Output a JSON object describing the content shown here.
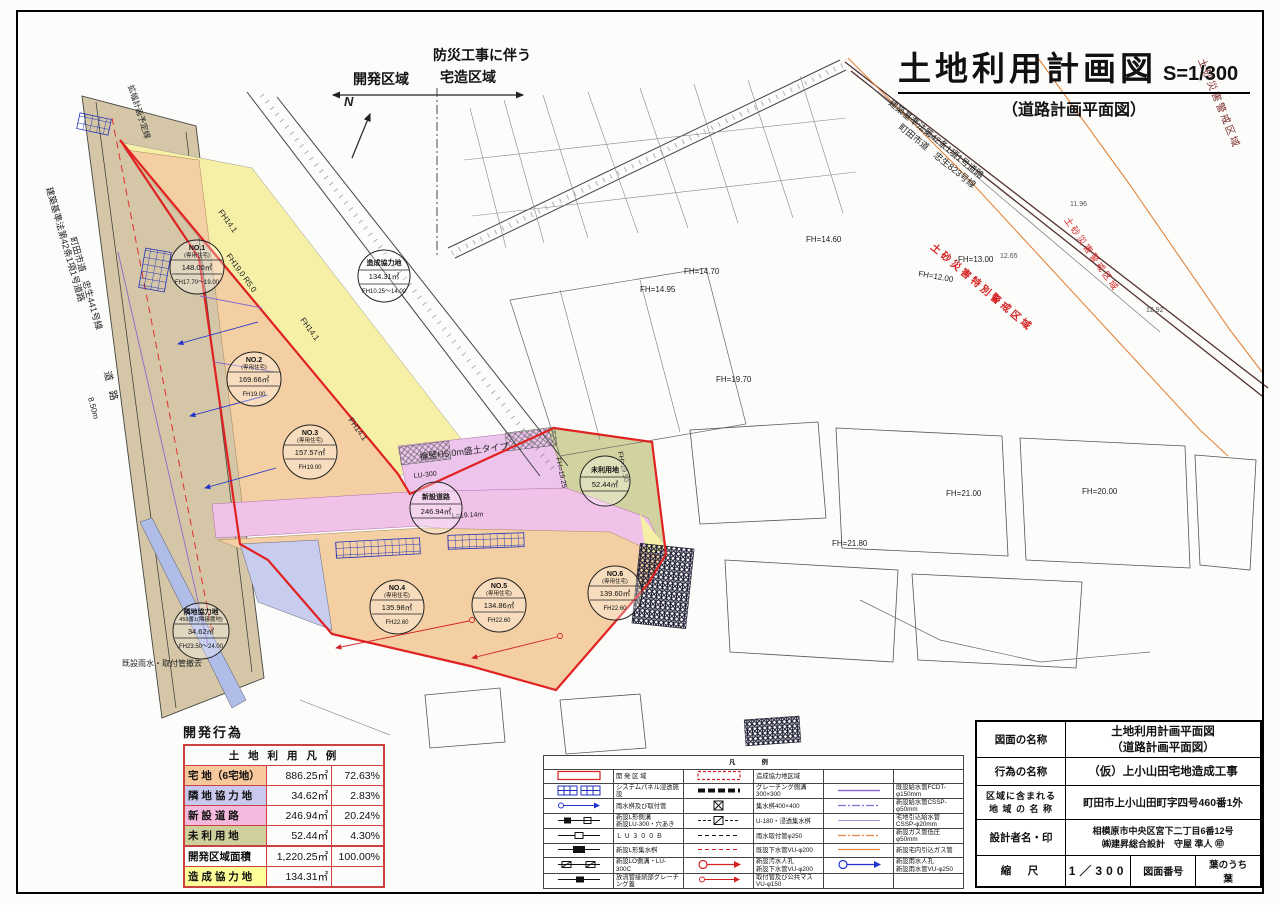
{
  "title": {
    "main": "土地利用計画図",
    "scale": "S=1/300",
    "sub": "（道路計画平面図）"
  },
  "plan": {
    "labels": {
      "r441a": "建築基準法第42条1項1号道路",
      "r441b": "町田市道　忠生441号線",
      "doro": "道　路",
      "kaku": "拡幅計画予定線",
      "m850": "8.50m",
      "r823a": "建築基準法第42条1項1号道路",
      "r823b": "町田市道　忠生823号線",
      "toku1": "土砂災害特別警戒区域",
      "kei1": "土砂災害警戒区域",
      "kei2": "土砂災害警戒区域",
      "f1460": "FH=14.60",
      "f1300": "FH=13.00",
      "f1200": "FH=12.00",
      "f1495": "FH=14.95",
      "f1470": "FH=14.70",
      "f1970": "FH=19.70",
      "f2180": "FH=21.80",
      "f2100": "FH=21.00",
      "f2000": "FH=20.00",
      "f1950": "FH=19.50",
      "f1925": "FH=19.25",
      "f141a": "FH14.1",
      "f141b": "FH14.1",
      "f141c": "FH14.1",
      "f190": "FH19.0 R5.0",
      "youheki": "擁壁H5.0m盛土タイプ",
      "l1914": "L=19.14m",
      "lu300": "LU-300",
      "kisetsu": "既設雨水・取付管撤去",
      "e1": "12.65",
      "e2": "12.92",
      "e3": "11.96",
      "zoneL": "開発区域",
      "zoneR1": "防災工事に伴う",
      "zoneR2": "宅造区域",
      "north": "N"
    },
    "circles": [
      {
        "l1": "NO.1",
        "l2": "(専用住宅)",
        "l3": "148.00㎡",
        "l4": "FH17.70～19.00"
      },
      {
        "l1": "NO.2",
        "l2": "(専用住宅)",
        "l3": "169.66㎡",
        "l4": "FH19.00"
      },
      {
        "l1": "NO.3",
        "l2": "(専用住宅)",
        "l3": "157.57㎡",
        "l4": "FH19.00"
      },
      {
        "l1": "NO.4",
        "l2": "(専用住宅)",
        "l3": "135.98㎡",
        "l4": "FH22.60"
      },
      {
        "l1": "NO.5",
        "l2": "(専用住宅)",
        "l3": "134.86㎡",
        "l4": "FH22.60"
      },
      {
        "l1": "NO.6",
        "l2": "(専用住宅)",
        "l3": "139.60㎡",
        "l4": "FH22.60"
      },
      {
        "l1": "造成協力地",
        "l3": "134.31㎡",
        "l4": "FH10.25～14.00"
      },
      {
        "l1": "新設道路",
        "l3": "246.94㎡"
      },
      {
        "l1": "未利用地",
        "l3": "52.44㎡"
      },
      {
        "l1": "隣地協力地",
        "l2": "459番1(隣接農地)",
        "l3": "34.62㎡",
        "l4": "FH23.50～24.00"
      }
    ]
  },
  "landuse": {
    "caption": "開発行為",
    "header": "土 地 利 用 凡 例",
    "rows": [
      {
        "label": "宅 地（6宅地）",
        "area": "886.25㎡",
        "pct": "72.63%",
        "color": "#f7c89b"
      },
      {
        "label": "隣 地 協 力 地",
        "area": "34.62㎡",
        "pct": "2.83%",
        "color": "#c9c9f0"
      },
      {
        "label": "新 設 道 路",
        "area": "246.94㎡",
        "pct": "20.24%",
        "color": "#f4bade"
      },
      {
        "label": "未 利 用 地",
        "area": "52.44㎡",
        "pct": "4.30%",
        "color": "#cfcf9b"
      },
      {
        "label": "開発区域面積",
        "area": "1,220.25㎡",
        "pct": "100.00%",
        "color": "#ffffff"
      },
      {
        "label": "造 成 協 力 地",
        "area": "134.31㎡",
        "pct": "",
        "color": "#ffff99"
      }
    ]
  },
  "legend": {
    "title": "凡　例",
    "rows": [
      {
        "c1": "開 発 区 域",
        "c2": "造成協力地区域",
        "c3": ""
      },
      {
        "c1": "システムパネル浸透施設",
        "c2": "グレーチング側溝300×300",
        "c3": "既設給水管FCDT-φ150mm"
      },
      {
        "c1": "雨水桝及び取付管",
        "c2": "集水桝400×400",
        "c3": "新設給水管CSSP-φ50mm"
      },
      {
        "c1": "新設L形側溝\n新設LU-300・穴あき",
        "c2": "U-180・浸透集水桝",
        "c3": "宅地引込給水管\nCSSP-φ20mm"
      },
      {
        "c1": "Ｌ Ｕ ３ ０ ０ Ｂ",
        "c2": "雨水取付管φ250",
        "c3": "新設ガス管低圧φ50mm"
      },
      {
        "c1": "新設L形集水桝",
        "c2": "既設下水管VU-φ200",
        "c3": "新設宅内引込ガス管"
      },
      {
        "c1": "新設LO側溝・LU-300C",
        "c2": "新設汚水人孔\n新設下水管VU-φ200",
        "c3": "新設雨水人孔\n新設雨水管VU-φ250"
      },
      {
        "c1": "放流管接続部グレーチング蓋",
        "c2": "取付管及び公共マス\nVU-φ150",
        "c3": ""
      }
    ]
  },
  "titleblock": {
    "rows": [
      {
        "label": "図面の名称",
        "value": "土地利用計画平面図\n（道路計画平面図）"
      },
      {
        "label": "行為の名称",
        "value": "（仮）上小山田宅地造成工事"
      },
      {
        "label": "区域に含まれる\n地 域 の 名 称",
        "value": "町田市上小山田町字四号460番1外"
      },
      {
        "label": "設計者名・印",
        "value": "相模原市中央区宮下二丁目6番12号\n㈱建昇総合設計　守屋 準人 ㊞"
      }
    ],
    "scale_label": "縮　尺",
    "scale_value": "1／300",
    "sheet_label": "図面番号",
    "sheet_value": "葉のうち　　葉"
  }
}
